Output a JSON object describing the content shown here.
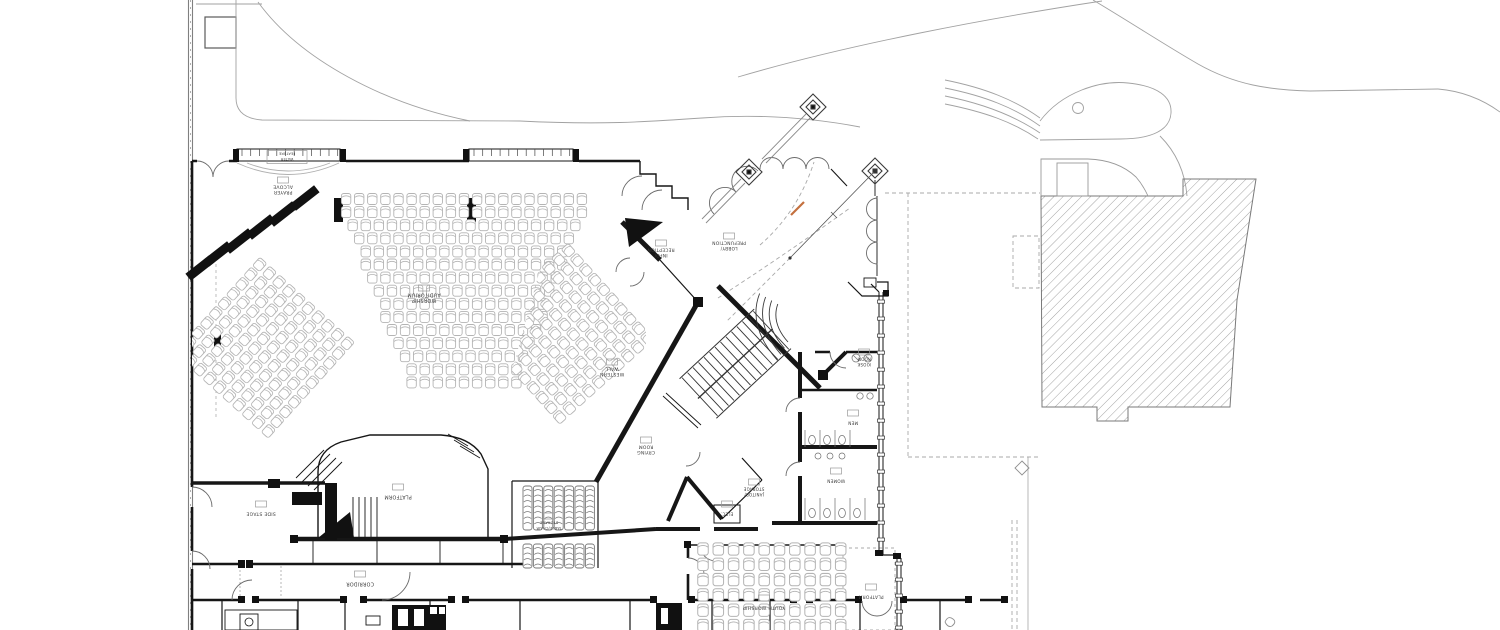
{
  "colors": {
    "wall": "#161616",
    "site_line": "#a2a2a2",
    "hatch": "#8d8d8d",
    "chair": "#b4b4b4",
    "label": "#3a3a3a",
    "accent_orange": "#c4703f"
  },
  "rooms": [
    {
      "id": "water_feature",
      "lines": [
        "WATER",
        "FEATURE"
      ]
    },
    {
      "id": "prayer_alcove",
      "lines": [
        "PRAYER",
        "ALCOVE"
      ]
    },
    {
      "id": "worship_auditorium",
      "lines": [
        "WORSHIP",
        "AUDITORIUM"
      ]
    },
    {
      "id": "western_wall",
      "lines": [
        "WESTERN",
        "WALL"
      ]
    },
    {
      "id": "info_reception",
      "lines": [
        "INFO/",
        "RECEPTION"
      ]
    },
    {
      "id": "lobby_prefunction",
      "lines": [
        "LOBBY/",
        "PREFUNCTION"
      ]
    },
    {
      "id": "crying_room",
      "lines": [
        "CRYING",
        "ROOM"
      ]
    },
    {
      "id": "janitor_storage",
      "lines": [
        "JANITOR/",
        "STORAGE"
      ]
    },
    {
      "id": "elec",
      "lines": [
        "ELEC."
      ]
    },
    {
      "id": "kiosk_room",
      "lines": [
        "KIOSK",
        "ROOM"
      ]
    },
    {
      "id": "men",
      "lines": [
        "MEN"
      ]
    },
    {
      "id": "women",
      "lines": [
        "WOMEN"
      ]
    },
    {
      "id": "side_stage",
      "lines": [
        "SIDE STAGE"
      ]
    },
    {
      "id": "platform_main",
      "lines": [
        "PLATFORM"
      ]
    },
    {
      "id": "table_chair_storage",
      "lines": [
        "TABLE/CHAIR",
        "STORAGE"
      ]
    },
    {
      "id": "corridor",
      "lines": [
        "CORRIDOR"
      ]
    },
    {
      "id": "youth_worship",
      "lines": [
        "YOUTH WORSHIP"
      ]
    },
    {
      "id": "platform_youth",
      "lines": [
        "PLATFORM"
      ]
    }
  ],
  "seating": {
    "center_block": {
      "rows": 15,
      "row_pitch": 13.1,
      "chair_pitch": 13.1,
      "cx": 464,
      "y_top": 199,
      "half_width_top": 127,
      "half_width_bottom": 57
    },
    "left_wing": {
      "pivot": [
        262,
        350
      ],
      "angle": 42,
      "rows": 10,
      "y0": -62,
      "row_pitch": 13.1,
      "chair_pitch": 13.1,
      "half_width": 66
    },
    "right_wing": {
      "pivot": [
        566,
        336
      ],
      "angle": -42,
      "rows": 10,
      "y0": -62,
      "row_pitch": 13.1,
      "chair_pitch": 13.1,
      "half_width": 66
    },
    "youth_worship": {
      "cols": 10,
      "rows": 7,
      "x0": 703,
      "y0": 549,
      "pitch": 15.3,
      "scale": 1.12
    },
    "chair_storage": {
      "cols": 7,
      "x0": 523,
      "col_pitch": 10.4,
      "bands": [
        {
          "y": 486,
          "h": 44
        },
        {
          "y": 544,
          "h": 24
        }
      ]
    }
  }
}
